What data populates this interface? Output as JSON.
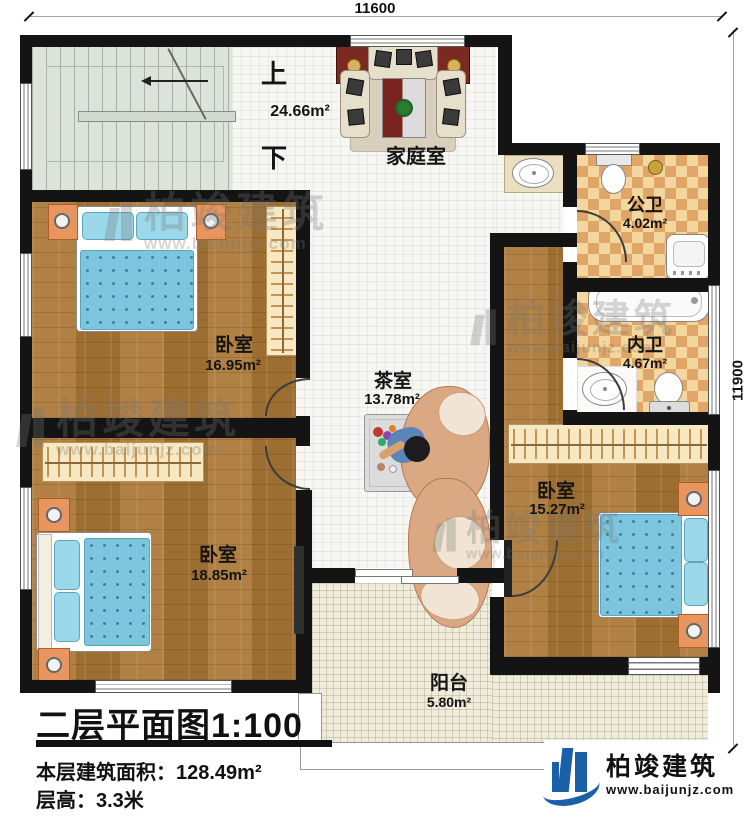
{
  "dims": {
    "top": "11600",
    "right": "11900"
  },
  "stair": {
    "up": "上",
    "down": "下"
  },
  "rooms": {
    "family_room": {
      "name": "家庭室",
      "area": "24.66m²"
    },
    "public_bathroom": {
      "name": "公卫",
      "area": "4.02m²"
    },
    "inner_bathroom": {
      "name": "内卫",
      "area": "4.67m²"
    },
    "bedroom_top_left": {
      "name": "卧室",
      "area": "16.95m²"
    },
    "tea_room": {
      "name": "茶室",
      "area": "13.78m²"
    },
    "bedroom_bottom_left": {
      "name": "卧室",
      "area": "18.85m²"
    },
    "bedroom_right": {
      "name": "卧室",
      "area": "15.27m²"
    },
    "balcony": {
      "name": "阳台",
      "area": "5.80m²"
    }
  },
  "titleblock": {
    "plan_title": "二层平面图1:100",
    "area_label": "本层建筑面积：",
    "area_value": "128.49m²",
    "height_label": "层高：",
    "height_value": "3.3米"
  },
  "brand": {
    "name": "柏竣建筑",
    "url": "www.baijunjz.com",
    "accent_color": "#1a5fa8"
  },
  "watermark": {
    "name": "柏竣建筑",
    "url": "www.baijunjz.com"
  }
}
